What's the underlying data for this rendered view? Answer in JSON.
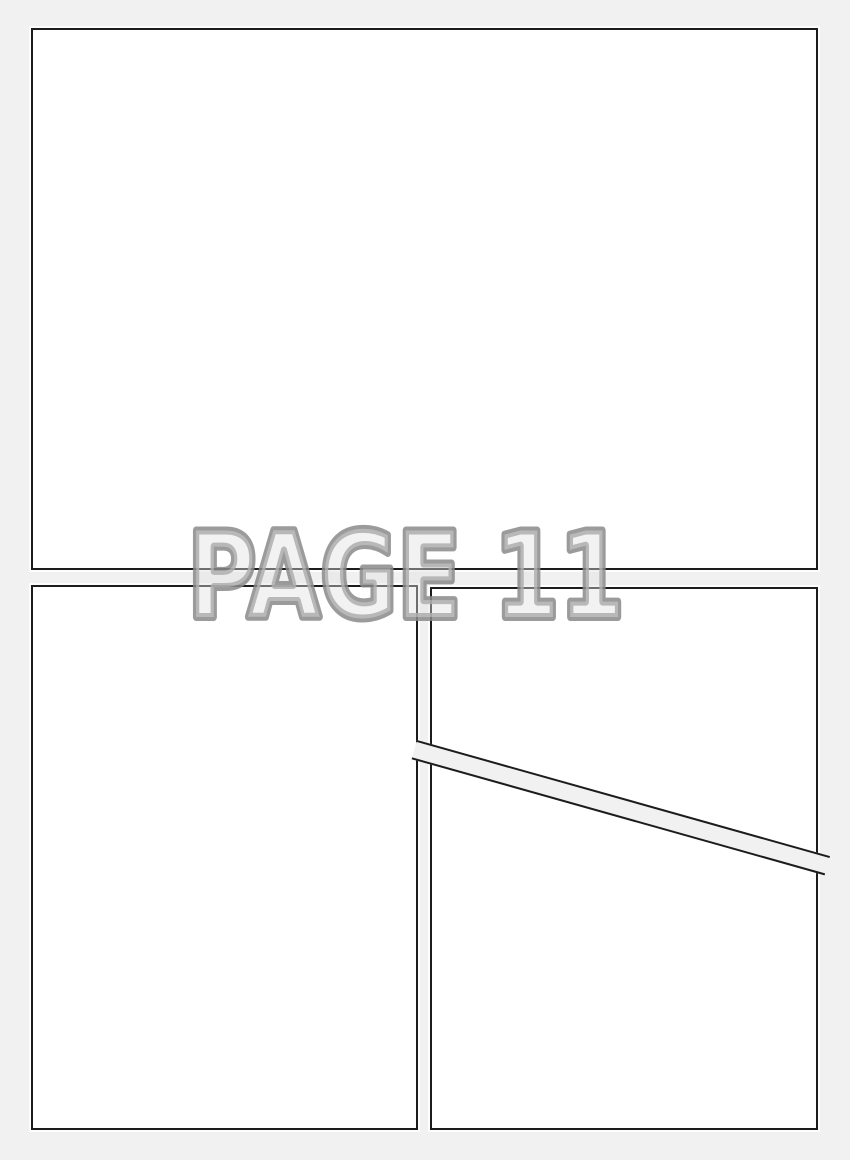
{
  "page": {
    "watermark_text": "PAGE 11",
    "panel_count": 4,
    "colors": {
      "page-bg": "#f1f1f2",
      "panel-fill": "#ffffff",
      "panel-border": "#1c1c1c",
      "watermark-fill": "#e0e0e0",
      "watermark-stroke": "#8a8a8a"
    }
  }
}
